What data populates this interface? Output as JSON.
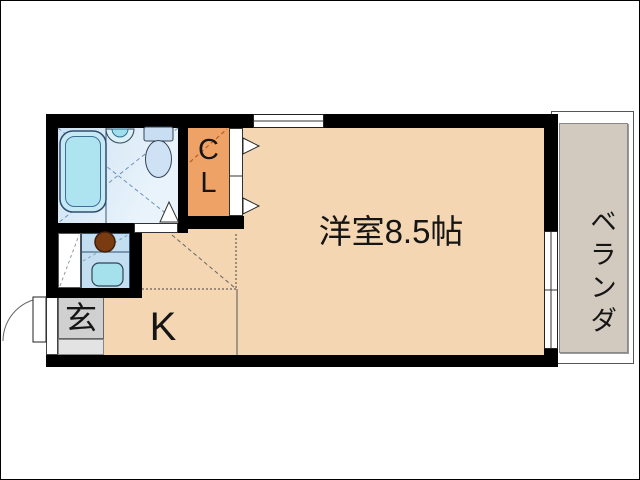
{
  "floorplan": {
    "type": "japanese-apartment-floor-plan",
    "rooms": {
      "main": {
        "label": "洋室8.5帖"
      },
      "kitchen": {
        "label": "K"
      },
      "entrance": {
        "label": "玄"
      },
      "closet": {
        "label": "CL",
        "letter_top": "C",
        "letter_bottom": "L"
      },
      "veranda": {
        "label": "ベランダ"
      }
    },
    "colors": {
      "room_fill": "#f4d6b3",
      "closet_fill": "#efa266",
      "bath_floor": "#dbe9f6",
      "bathtub_fill": "#aee3f0",
      "fixture_blue": "#cfe2f5",
      "counter_fill": "#c2def0",
      "counter_sink_fill": "#a5e1ec",
      "burner_fill": "#7a3b10",
      "entrance_gray": "#d0d0d0",
      "entrance_step_gray": "#e3e3e3",
      "veranda_gray": "#d3cabf",
      "wall": "#000000"
    }
  }
}
